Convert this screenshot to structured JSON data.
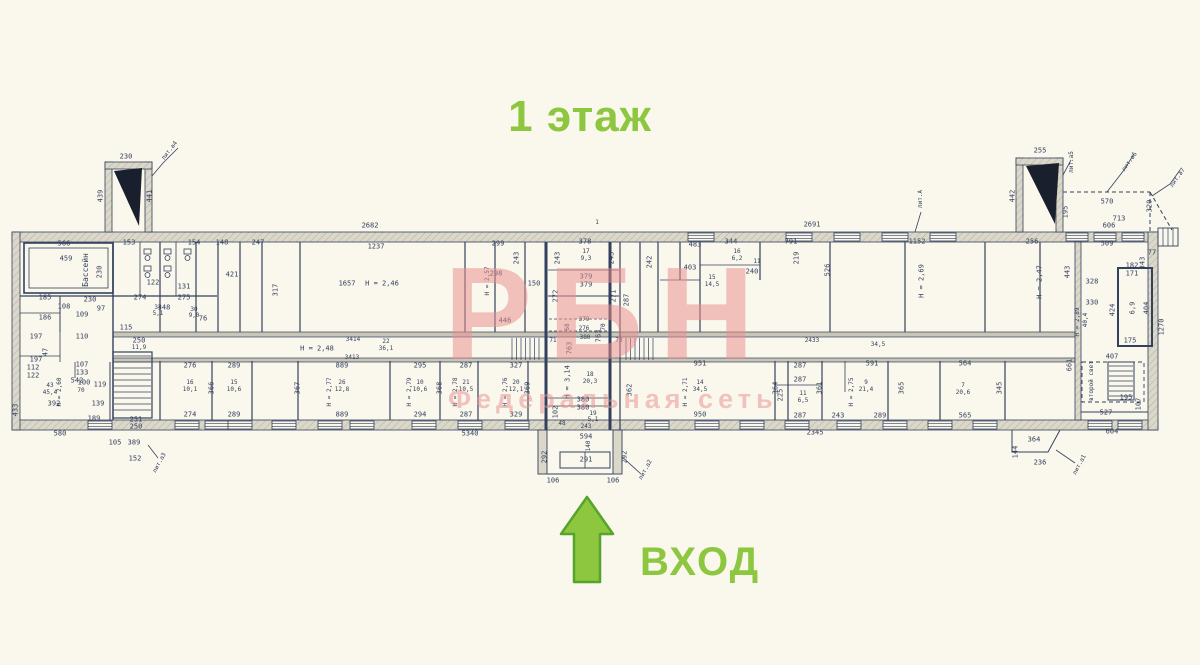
{
  "title": {
    "text": "1 этаж"
  },
  "entrance": {
    "label": "ВХОД"
  },
  "watermark": {
    "brand": "РБН",
    "subtitle": "Федеральная сеть"
  },
  "colors": {
    "accent_green": "#8dc63f",
    "arrow_outline": "#55a42b",
    "watermark_pink": "#e98f8f",
    "ink": "#33415e",
    "paper": "#faf7ec",
    "wall_fill": "#d8d5c6"
  },
  "plan": {
    "labels": [
      {
        "t": "230",
        "x": 126,
        "y": 157
      },
      {
        "t": "лит.а4",
        "x": 170,
        "y": 151,
        "r": -52,
        "s": 6
      },
      {
        "t": "439",
        "x": 101,
        "y": 196,
        "r": -90
      },
      {
        "t": "441",
        "x": 150,
        "y": 196,
        "r": -90
      },
      {
        "t": "2682",
        "x": 370,
        "y": 226
      },
      {
        "t": "1",
        "x": 597,
        "y": 223,
        "s": 6
      },
      {
        "t": "2691",
        "x": 812,
        "y": 225
      },
      {
        "t": "255",
        "x": 1040,
        "y": 151
      },
      {
        "t": "442",
        "x": 1013,
        "y": 196,
        "r": -90
      },
      {
        "t": "195",
        "x": 1066,
        "y": 212,
        "r": -90
      },
      {
        "t": "лит.а5",
        "x": 1072,
        "y": 162,
        "r": -90,
        "s": 6
      },
      {
        "t": "лит.а6",
        "x": 1130,
        "y": 162,
        "r": -55,
        "s": 6
      },
      {
        "t": "лит.а7",
        "x": 1178,
        "y": 178,
        "r": -55,
        "s": 6
      },
      {
        "t": "570",
        "x": 1107,
        "y": 202
      },
      {
        "t": "320",
        "x": 1150,
        "y": 206,
        "r": -90
      },
      {
        "t": "713",
        "x": 1119,
        "y": 219
      },
      {
        "t": "606",
        "x": 1109,
        "y": 226
      },
      {
        "t": "509",
        "x": 1107,
        "y": 244
      },
      {
        "t": "77",
        "x": 1152,
        "y": 253
      },
      {
        "t": "лит.А",
        "x": 921,
        "y": 199,
        "r": -90,
        "s": 6
      },
      {
        "t": "566",
        "x": 64,
        "y": 244
      },
      {
        "t": "459",
        "x": 66,
        "y": 259
      },
      {
        "t": "Бассейн",
        "x": 86,
        "y": 270,
        "r": -90,
        "s": 8
      },
      {
        "t": "230",
        "x": 100,
        "y": 272,
        "r": -90
      },
      {
        "t": "153",
        "x": 129,
        "y": 243
      },
      {
        "t": "154",
        "x": 194,
        "y": 243
      },
      {
        "t": "148",
        "x": 222,
        "y": 243
      },
      {
        "t": "247",
        "x": 258,
        "y": 243
      },
      {
        "t": "122",
        "x": 153,
        "y": 283
      },
      {
        "t": "131",
        "x": 184,
        "y": 287
      },
      {
        "t": "274",
        "x": 140,
        "y": 298
      },
      {
        "t": "275",
        "x": 184,
        "y": 298
      },
      {
        "t": "348",
        "x": 164,
        "y": 308
      },
      {
        "t": "421",
        "x": 232,
        "y": 275
      },
      {
        "t": "317",
        "x": 276,
        "y": 290,
        "r": -90
      },
      {
        "t": "1237",
        "x": 376,
        "y": 247
      },
      {
        "t": "1657",
        "x": 347,
        "y": 284
      },
      {
        "t": "Н = 2,46",
        "x": 382,
        "y": 284
      },
      {
        "t": "446",
        "x": 505,
        "y": 321
      },
      {
        "t": "299",
        "x": 498,
        "y": 244
      },
      {
        "t": "298",
        "x": 496,
        "y": 274
      },
      {
        "t": "Н = 2,57",
        "x": 488,
        "y": 281,
        "r": -90,
        "s": 6
      },
      {
        "t": "150",
        "x": 534,
        "y": 284
      },
      {
        "t": "243",
        "x": 517,
        "y": 258,
        "r": -90
      },
      {
        "t": "378",
        "x": 585,
        "y": 242
      },
      {
        "t": "17",
        "x": 586,
        "y": 252,
        "s": 6
      },
      {
        "t": "9,3",
        "x": 586,
        "y": 259,
        "s": 6
      },
      {
        "t": "243",
        "x": 558,
        "y": 258,
        "r": -90
      },
      {
        "t": "243",
        "x": 612,
        "y": 258,
        "r": -90
      },
      {
        "t": "379",
        "x": 586,
        "y": 277
      },
      {
        "t": "379",
        "x": 586,
        "y": 285
      },
      {
        "t": "272",
        "x": 556,
        "y": 296,
        "r": -90
      },
      {
        "t": "271",
        "x": 614,
        "y": 296,
        "r": -90
      },
      {
        "t": "287",
        "x": 627,
        "y": 300,
        "r": -90
      },
      {
        "t": "344",
        "x": 731,
        "y": 242
      },
      {
        "t": "16",
        "x": 737,
        "y": 252,
        "s": 6
      },
      {
        "t": "6,2",
        "x": 737,
        "y": 259,
        "s": 6
      },
      {
        "t": "242",
        "x": 650,
        "y": 262,
        "r": -90
      },
      {
        "t": "219",
        "x": 797,
        "y": 258,
        "r": -90
      },
      {
        "t": "791",
        "x": 791,
        "y": 242
      },
      {
        "t": "483",
        "x": 695,
        "y": 245
      },
      {
        "t": "403",
        "x": 690,
        "y": 268
      },
      {
        "t": "15",
        "x": 712,
        "y": 278,
        "s": 6
      },
      {
        "t": "14,5",
        "x": 712,
        "y": 285,
        "s": 6
      },
      {
        "t": "240",
        "x": 752,
        "y": 272
      },
      {
        "t": "11",
        "x": 757,
        "y": 262,
        "s": 6
      },
      {
        "t": "526",
        "x": 828,
        "y": 270,
        "r": -90
      },
      {
        "t": "1152",
        "x": 917,
        "y": 242
      },
      {
        "t": "Н = 2,69",
        "x": 922,
        "y": 281,
        "r": -90
      },
      {
        "t": "256",
        "x": 1032,
        "y": 242
      },
      {
        "t": "Н = 2,47",
        "x": 1040,
        "y": 282,
        "r": -90
      },
      {
        "t": "443",
        "x": 1068,
        "y": 272,
        "r": -90
      },
      {
        "t": "328",
        "x": 1092,
        "y": 282
      },
      {
        "t": "330",
        "x": 1092,
        "y": 303
      },
      {
        "t": "Н = 2,89",
        "x": 1078,
        "y": 322,
        "r": -90,
        "s": 6
      },
      {
        "t": "40,4",
        "x": 1086,
        "y": 320,
        "r": -90,
        "s": 6
      },
      {
        "t": "182",
        "x": 1132,
        "y": 266
      },
      {
        "t": "171",
        "x": 1132,
        "y": 274
      },
      {
        "t": "6,9",
        "x": 1133,
        "y": 308,
        "r": -90
      },
      {
        "t": "424",
        "x": 1113,
        "y": 310,
        "r": -90
      },
      {
        "t": "404",
        "x": 1147,
        "y": 308,
        "r": -90
      },
      {
        "t": "175",
        "x": 1130,
        "y": 341
      },
      {
        "t": "407",
        "x": 1112,
        "y": 357
      },
      {
        "t": "второй свет",
        "x": 1092,
        "y": 381,
        "r": -90,
        "s": 6
      },
      {
        "t": "195",
        "x": 1126,
        "y": 398
      },
      {
        "t": "107",
        "x": 1139,
        "y": 404,
        "r": -90
      },
      {
        "t": "527",
        "x": 1106,
        "y": 413
      },
      {
        "t": "604",
        "x": 1112,
        "y": 432
      },
      {
        "t": "1270",
        "x": 1162,
        "y": 327,
        "r": -90
      },
      {
        "t": "343",
        "x": 1143,
        "y": 263,
        "r": -90
      },
      {
        "t": "661",
        "x": 1070,
        "y": 365,
        "r": -90
      },
      {
        "t": "3414",
        "x": 353,
        "y": 340,
        "s": 6
      },
      {
        "t": "Н = 2,48",
        "x": 317,
        "y": 349
      },
      {
        "t": "3413",
        "x": 352,
        "y": 358,
        "s": 6
      },
      {
        "t": "22",
        "x": 386,
        "y": 342,
        "s": 6
      },
      {
        "t": "36,1",
        "x": 386,
        "y": 349,
        "s": 6
      },
      {
        "t": "2433",
        "x": 812,
        "y": 341,
        "s": 6
      },
      {
        "t": "34,5",
        "x": 878,
        "y": 345,
        "s": 6
      },
      {
        "t": "276",
        "x": 190,
        "y": 366
      },
      {
        "t": "289",
        "x": 234,
        "y": 366
      },
      {
        "t": "889",
        "x": 342,
        "y": 366
      },
      {
        "t": "295",
        "x": 420,
        "y": 366
      },
      {
        "t": "287",
        "x": 466,
        "y": 366
      },
      {
        "t": "327",
        "x": 516,
        "y": 366
      },
      {
        "t": "16",
        "x": 190,
        "y": 383,
        "s": 6
      },
      {
        "t": "10,1",
        "x": 190,
        "y": 390,
        "s": 6
      },
      {
        "t": "15",
        "x": 234,
        "y": 383,
        "s": 6
      },
      {
        "t": "10,6",
        "x": 234,
        "y": 390,
        "s": 6
      },
      {
        "t": "26",
        "x": 342,
        "y": 383,
        "s": 6
      },
      {
        "t": "12,8",
        "x": 342,
        "y": 390,
        "s": 6
      },
      {
        "t": "Н = 2,77",
        "x": 330,
        "y": 392,
        "r": -90,
        "s": 6
      },
      {
        "t": "10",
        "x": 420,
        "y": 383,
        "s": 6
      },
      {
        "t": "10,6",
        "x": 420,
        "y": 390,
        "s": 6
      },
      {
        "t": "Н = 2,79",
        "x": 410,
        "y": 392,
        "r": -90,
        "s": 6
      },
      {
        "t": "21",
        "x": 466,
        "y": 383,
        "s": 6
      },
      {
        "t": "10,5",
        "x": 466,
        "y": 390,
        "s": 6
      },
      {
        "t": "Н = 2,78",
        "x": 456,
        "y": 392,
        "r": -90,
        "s": 6
      },
      {
        "t": "20",
        "x": 516,
        "y": 383,
        "s": 6
      },
      {
        "t": "12,1",
        "x": 516,
        "y": 390,
        "s": 6
      },
      {
        "t": "Н = 2,76",
        "x": 506,
        "y": 392,
        "r": -90,
        "s": 6
      },
      {
        "t": "274",
        "x": 190,
        "y": 415
      },
      {
        "t": "289",
        "x": 234,
        "y": 415
      },
      {
        "t": "889",
        "x": 342,
        "y": 415
      },
      {
        "t": "294",
        "x": 420,
        "y": 415
      },
      {
        "t": "287",
        "x": 466,
        "y": 415
      },
      {
        "t": "329",
        "x": 516,
        "y": 415
      },
      {
        "t": "366",
        "x": 212,
        "y": 388,
        "r": -90
      },
      {
        "t": "367",
        "x": 298,
        "y": 388,
        "r": -90
      },
      {
        "t": "368",
        "x": 440,
        "y": 388,
        "r": -90
      },
      {
        "t": "369",
        "x": 528,
        "y": 388,
        "r": -90
      },
      {
        "t": "379",
        "x": 584,
        "y": 320,
        "s": 6
      },
      {
        "t": "276",
        "x": 584,
        "y": 329,
        "s": 6
      },
      {
        "t": "380",
        "x": 585,
        "y": 338,
        "s": 6
      },
      {
        "t": "68",
        "x": 568,
        "y": 327,
        "r": -90,
        "s": 6
      },
      {
        "t": "70",
        "x": 604,
        "y": 327,
        "r": -90,
        "s": 6
      },
      {
        "t": "71",
        "x": 553,
        "y": 341,
        "s": 6
      },
      {
        "t": "73",
        "x": 619,
        "y": 341,
        "s": 6
      },
      {
        "t": "763",
        "x": 570,
        "y": 348,
        "r": -90
      },
      {
        "t": "763",
        "x": 599,
        "y": 336,
        "r": -90
      },
      {
        "t": "Н = 3,14",
        "x": 568,
        "y": 382,
        "r": -90
      },
      {
        "t": "18",
        "x": 590,
        "y": 375,
        "s": 6
      },
      {
        "t": "20,3",
        "x": 590,
        "y": 382,
        "s": 6
      },
      {
        "t": "380",
        "x": 583,
        "y": 400
      },
      {
        "t": "380",
        "x": 583,
        "y": 408
      },
      {
        "t": "19",
        "x": 593,
        "y": 414,
        "s": 6
      },
      {
        "t": "5,1",
        "x": 593,
        "y": 420,
        "s": 6
      },
      {
        "t": "102",
        "x": 556,
        "y": 412,
        "r": -90
      },
      {
        "t": "48",
        "x": 562,
        "y": 424,
        "s": 6
      },
      {
        "t": "243",
        "x": 586,
        "y": 427,
        "s": 6
      },
      {
        "t": "594",
        "x": 586,
        "y": 437
      },
      {
        "t": "140",
        "x": 589,
        "y": 446,
        "r": -90,
        "s": 6
      },
      {
        "t": "292",
        "x": 545,
        "y": 457,
        "r": -90
      },
      {
        "t": "292",
        "x": 625,
        "y": 457,
        "r": -90
      },
      {
        "t": "291",
        "x": 586,
        "y": 460
      },
      {
        "t": "106",
        "x": 553,
        "y": 481
      },
      {
        "t": "106",
        "x": 613,
        "y": 481
      },
      {
        "t": "лит.а2",
        "x": 646,
        "y": 470,
        "r": -62,
        "s": 6
      },
      {
        "t": "951",
        "x": 700,
        "y": 364
      },
      {
        "t": "14",
        "x": 700,
        "y": 383,
        "s": 6
      },
      {
        "t": "34,5",
        "x": 700,
        "y": 390,
        "s": 6
      },
      {
        "t": "Н = 2,71",
        "x": 686,
        "y": 392,
        "r": -90,
        "s": 6
      },
      {
        "t": "287",
        "x": 800,
        "y": 366
      },
      {
        "t": "287",
        "x": 800,
        "y": 380
      },
      {
        "t": "11",
        "x": 803,
        "y": 394,
        "s": 6
      },
      {
        "t": "6,5",
        "x": 803,
        "y": 401,
        "s": 6
      },
      {
        "t": "225",
        "x": 781,
        "y": 395,
        "r": -90
      },
      {
        "t": "591",
        "x": 872,
        "y": 364
      },
      {
        "t": "9",
        "x": 866,
        "y": 383,
        "s": 6
      },
      {
        "t": "21,4",
        "x": 866,
        "y": 390,
        "s": 6
      },
      {
        "t": "Н = 2,75",
        "x": 852,
        "y": 392,
        "r": -90,
        "s": 6
      },
      {
        "t": "564",
        "x": 965,
        "y": 364
      },
      {
        "t": "7",
        "x": 963,
        "y": 386,
        "s": 6
      },
      {
        "t": "20,6",
        "x": 963,
        "y": 393,
        "s": 6
      },
      {
        "t": "950",
        "x": 700,
        "y": 415
      },
      {
        "t": "287",
        "x": 800,
        "y": 416
      },
      {
        "t": "243",
        "x": 838,
        "y": 416
      },
      {
        "t": "289",
        "x": 880,
        "y": 416
      },
      {
        "t": "565",
        "x": 965,
        "y": 416
      },
      {
        "t": "362",
        "x": 630,
        "y": 390,
        "r": -90
      },
      {
        "t": "364",
        "x": 776,
        "y": 388,
        "r": -90
      },
      {
        "t": "361",
        "x": 820,
        "y": 388,
        "r": -90
      },
      {
        "t": "365",
        "x": 902,
        "y": 388,
        "r": -90
      },
      {
        "t": "345",
        "x": 1000,
        "y": 388,
        "r": -90
      },
      {
        "t": "2345",
        "x": 815,
        "y": 433
      },
      {
        "t": "5340",
        "x": 470,
        "y": 434
      },
      {
        "t": "580",
        "x": 60,
        "y": 434
      },
      {
        "t": "105",
        "x": 115,
        "y": 443
      },
      {
        "t": "389",
        "x": 134,
        "y": 443
      },
      {
        "t": "152",
        "x": 135,
        "y": 459
      },
      {
        "t": "лит.а3",
        "x": 160,
        "y": 463,
        "r": -62,
        "s": 6
      },
      {
        "t": "364",
        "x": 1034,
        "y": 440
      },
      {
        "t": "144",
        "x": 1016,
        "y": 452,
        "r": -90
      },
      {
        "t": "236",
        "x": 1040,
        "y": 463
      },
      {
        "t": "лит.а1",
        "x": 1080,
        "y": 465,
        "r": -62,
        "s": 6
      },
      {
        "t": "185",
        "x": 45,
        "y": 298
      },
      {
        "t": "186",
        "x": 45,
        "y": 318
      },
      {
        "t": "197",
        "x": 36,
        "y": 337
      },
      {
        "t": "47",
        "x": 46,
        "y": 352,
        "r": -90
      },
      {
        "t": "197",
        "x": 36,
        "y": 360
      },
      {
        "t": "112",
        "x": 33,
        "y": 368
      },
      {
        "t": "122",
        "x": 33,
        "y": 376
      },
      {
        "t": "392",
        "x": 54,
        "y": 404
      },
      {
        "t": "542",
        "x": 77,
        "y": 381
      },
      {
        "t": "Н = 2,60",
        "x": 60,
        "y": 392,
        "r": -90,
        "s": 6
      },
      {
        "t": "43",
        "x": 50,
        "y": 386,
        "s": 6
      },
      {
        "t": "45,4",
        "x": 50,
        "y": 393,
        "s": 6
      },
      {
        "t": "100",
        "x": 84,
        "y": 383
      },
      {
        "t": "119",
        "x": 100,
        "y": 385
      },
      {
        "t": "70",
        "x": 81,
        "y": 391,
        "s": 6
      },
      {
        "t": "139",
        "x": 98,
        "y": 404
      },
      {
        "t": "189",
        "x": 94,
        "y": 419
      },
      {
        "t": "133",
        "x": 82,
        "y": 373
      },
      {
        "t": "107",
        "x": 82,
        "y": 365
      },
      {
        "t": "110",
        "x": 82,
        "y": 337
      },
      {
        "t": "109",
        "x": 82,
        "y": 315
      },
      {
        "t": "108",
        "x": 64,
        "y": 307
      },
      {
        "t": "230",
        "x": 90,
        "y": 300
      },
      {
        "t": "97",
        "x": 101,
        "y": 309
      },
      {
        "t": "250",
        "x": 139,
        "y": 341
      },
      {
        "t": "11,9",
        "x": 139,
        "y": 348,
        "s": 6
      },
      {
        "t": "251",
        "x": 136,
        "y": 420
      },
      {
        "t": "250",
        "x": 136,
        "y": 427
      },
      {
        "t": "115",
        "x": 126,
        "y": 328
      },
      {
        "t": "34",
        "x": 158,
        "y": 308,
        "s": 6
      },
      {
        "t": "5,1",
        "x": 158,
        "y": 314,
        "s": 6
      },
      {
        "t": "30",
        "x": 194,
        "y": 310,
        "s": 6
      },
      {
        "t": "9,0",
        "x": 194,
        "y": 316,
        "s": 6
      },
      {
        "t": "76",
        "x": 203,
        "y": 319
      },
      {
        "t": "433",
        "x": 16,
        "y": 410,
        "r": -90
      }
    ]
  }
}
